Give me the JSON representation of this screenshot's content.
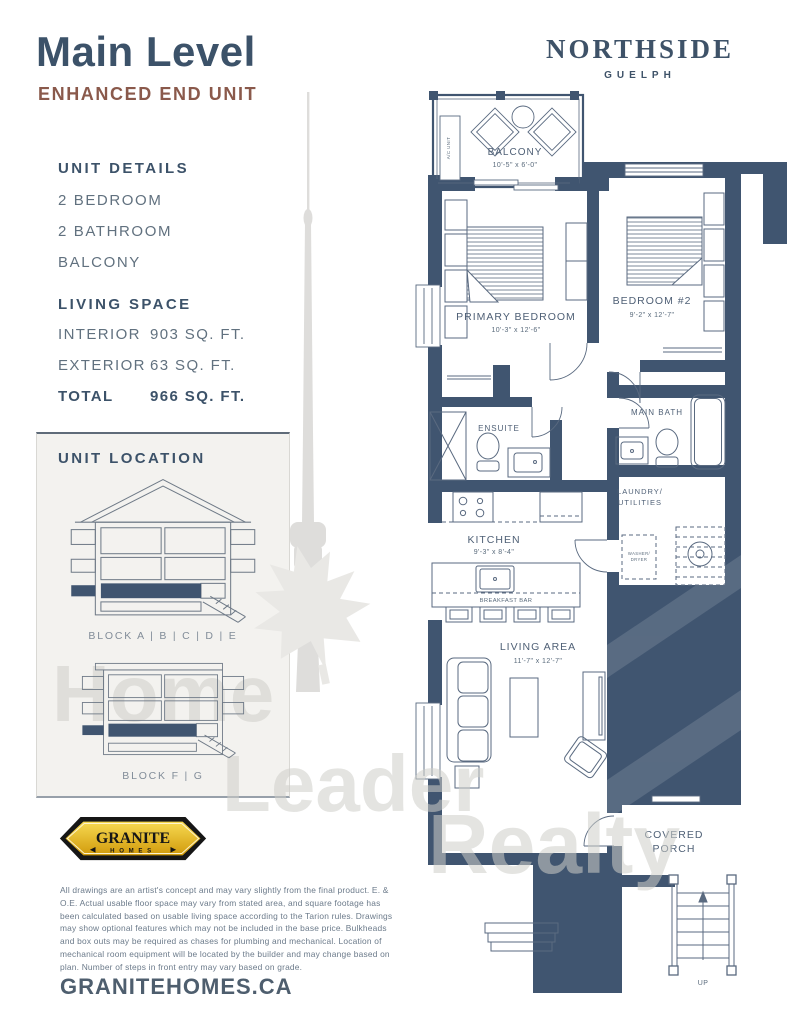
{
  "page": {
    "title": "Main Level",
    "subtitle": "ENHANCED END UNIT",
    "website": "GRANITEHOMES.CA",
    "disclaimer": "All drawings are an artist's concept and may vary slightly from the final product. E. & O.E. Actual usable floor space may vary from stated area, and square footage has been calculated based on usable living space according to the Tarion rules. Drawings may show optional features which may not be included in the base price. Bulkheads and box outs may be required as chases for plumbing and mechanical. Location of mechanical room equipment will be located by the builder and may change based on plan. Number of steps in front entry may vary based on grade."
  },
  "brand": {
    "name": "NORTHSIDE",
    "city": "GUELPH"
  },
  "builder_logo": {
    "name": "GRANITE",
    "sub": "HOMES"
  },
  "unit_details": {
    "heading": "UNIT DETAILS",
    "items": [
      "2 BEDROOM",
      "2 BATHROOM",
      "BALCONY"
    ]
  },
  "living_space": {
    "heading": "LIVING SPACE",
    "rows": [
      {
        "label": "INTERIOR",
        "value": "903 SQ. FT."
      },
      {
        "label": "EXTERIOR",
        "value": "63 SQ. FT."
      },
      {
        "label": "TOTAL",
        "value": "966 SQ. FT."
      }
    ]
  },
  "unit_location": {
    "heading": "UNIT LOCATION",
    "block_a_label": "BLOCK A | B | C | D | E",
    "block_f_label": "BLOCK F | G"
  },
  "floorplan": {
    "balcony": {
      "name": "BALCONY",
      "dims": "10'-5\" x 6'-0\""
    },
    "ac_unit": "A/C UNIT",
    "primary_bedroom": {
      "name": "PRIMARY BEDROOM",
      "dims": "10'-3\" x 12'-6\""
    },
    "bedroom2": {
      "name": "BEDROOM #2",
      "dims": "9'-2\" x 12'-7\""
    },
    "ensuite": {
      "name": "ENSUITE"
    },
    "main_bath": {
      "name": "MAIN BATH"
    },
    "laundry": {
      "line1": "LAUNDRY/",
      "line2": "UTILITIES"
    },
    "washer_dryer": {
      "line1": "WASHER/",
      "line2": "DRYER"
    },
    "kitchen": {
      "name": "KITCHEN",
      "dims": "9'-3\" x 8'-4\""
    },
    "breakfast_bar": "BREAKFAST BAR",
    "living_area": {
      "name": "LIVING AREA",
      "dims": "11'-7\" x 12'-7\""
    },
    "covered_porch": {
      "line1": "COVERED",
      "line2": "PORCH"
    },
    "up_label": "UP"
  },
  "watermark": {
    "word1": "Home",
    "word2": "Leader",
    "word3": "Realty"
  },
  "colors": {
    "accent_slate": "#3c5269",
    "wall": "#405570",
    "subtitle_rust": "#8a594b",
    "body_text": "#61717f",
    "logo_gold": "#e3b421",
    "watermark_gray": "#dcdcda"
  }
}
